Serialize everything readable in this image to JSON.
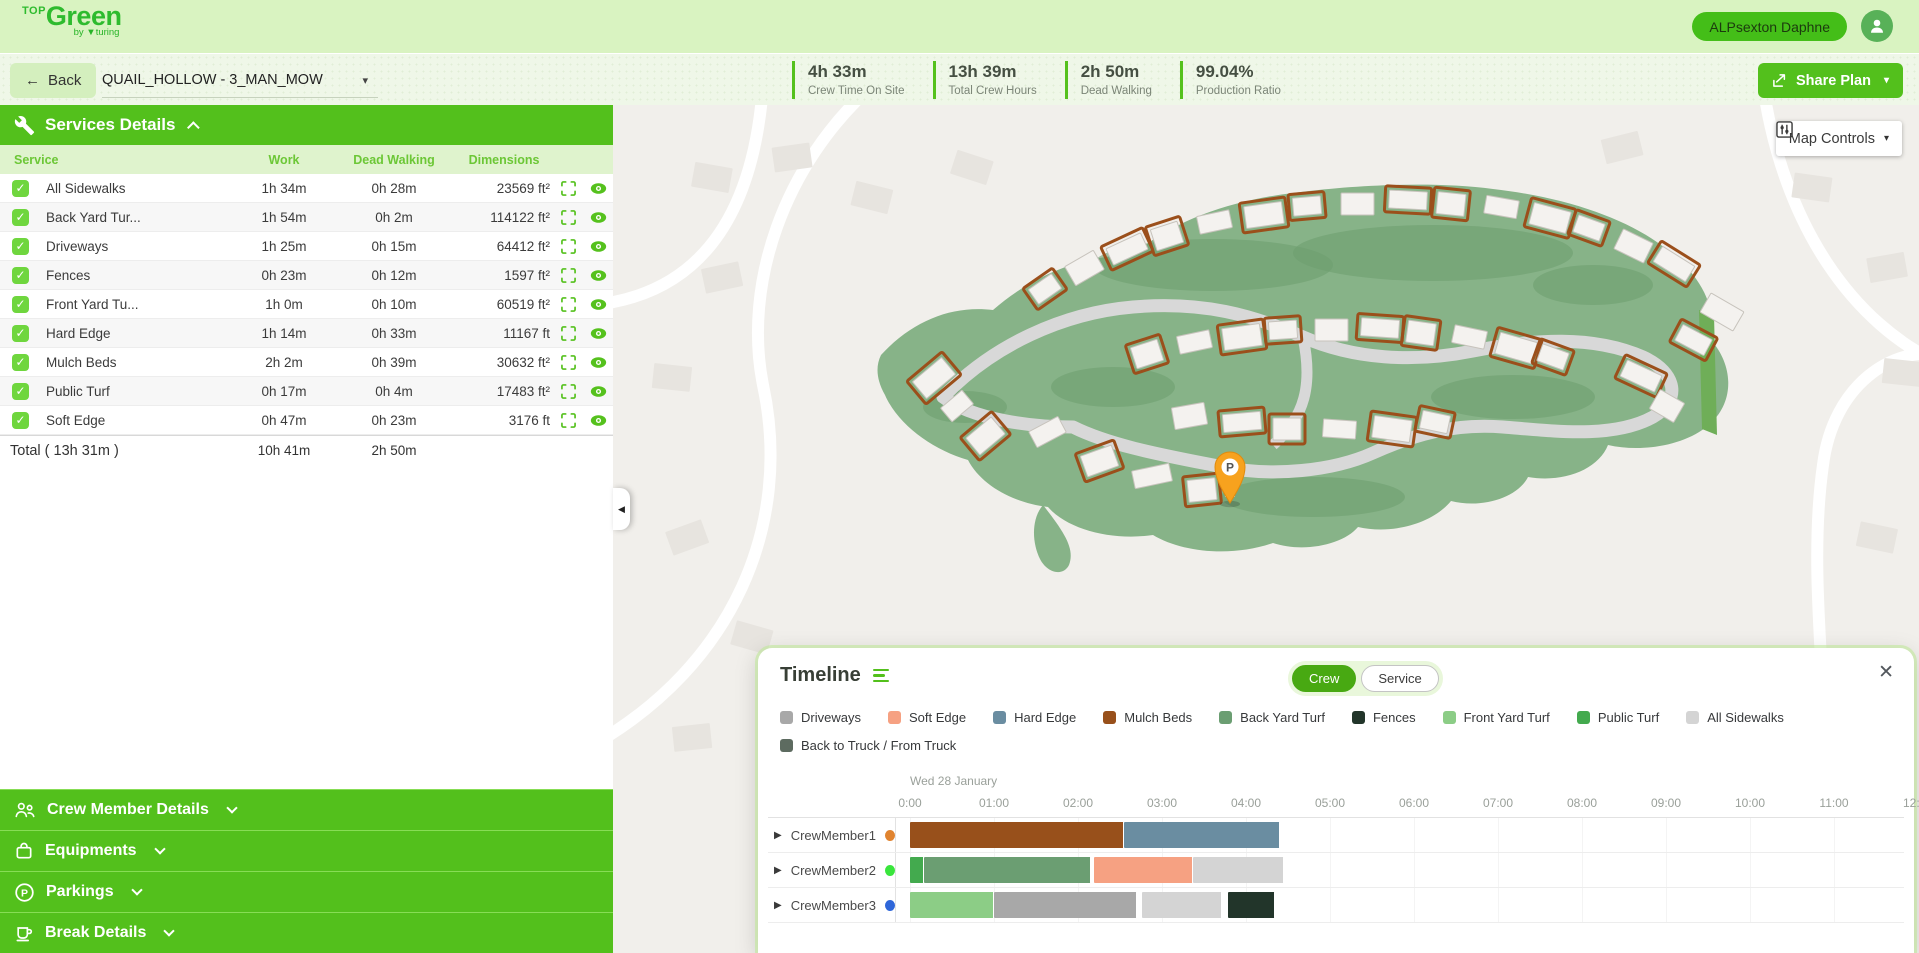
{
  "icons": {
    "caret_down": "▾",
    "back_arrow": "←",
    "row_expand": "▶",
    "panel_collapse": "◀",
    "close": "✕",
    "check": "✓"
  },
  "header": {
    "logo": {
      "top": "TOP",
      "main": "Green",
      "by": "by",
      "turing": "▼turing"
    },
    "user_name": "ALPsexton Daphne"
  },
  "toolbar": {
    "back_label": "Back",
    "plan_selector": "QUAIL_HOLLOW - 3_MAN_MOW",
    "stats": [
      {
        "value": "4h 33m",
        "label": "Crew Time On Site"
      },
      {
        "value": "13h 39m",
        "label": "Total Crew Hours"
      },
      {
        "value": "2h 50m",
        "label": "Dead Walking"
      },
      {
        "value": "99.04%",
        "label": "Production Ratio"
      }
    ],
    "share_label": "Share Plan"
  },
  "sidebar": {
    "services": {
      "title": "Services Details",
      "columns": [
        "Service",
        "Work",
        "Dead Walking",
        "Dimensions"
      ],
      "rows": [
        {
          "name": "All Sidewalks",
          "color": "#d6d6d6",
          "work": "1h 34m",
          "dead_walking": "0h 28m",
          "dimensions": "23569 ft²"
        },
        {
          "name": "Back Yard Tur...",
          "color": "#6b9e72",
          "work": "1h 54m",
          "dead_walking": "0h 2m",
          "dimensions": "114122 ft²"
        },
        {
          "name": "Driveways",
          "color": "#a8a8a8",
          "work": "1h 25m",
          "dead_walking": "0h 15m",
          "dimensions": "64412 ft²"
        },
        {
          "name": "Fences",
          "color": "#22352a",
          "work": "0h 23m",
          "dead_walking": "0h 12m",
          "dimensions": "1597 ft²"
        },
        {
          "name": "Front Yard Tu...",
          "color": "#8ccd86",
          "work": "1h 0m",
          "dead_walking": "0h 10m",
          "dimensions": "60519 ft²"
        },
        {
          "name": "Hard Edge",
          "color": "#6a8da1",
          "work": "1h 14m",
          "dead_walking": "0h 33m",
          "dimensions": "11167 ft"
        },
        {
          "name": "Mulch Beds",
          "color": "#98501b",
          "work": "2h 2m",
          "dead_walking": "0h 39m",
          "dimensions": "30632 ft²"
        },
        {
          "name": "Public Turf",
          "color": "#43aa4e",
          "work": "0h 17m",
          "dead_walking": "0h 4m",
          "dimensions": "17483 ft²"
        },
        {
          "name": "Soft Edge",
          "color": "#f6a182",
          "work": "0h 47m",
          "dead_walking": "0h 23m",
          "dimensions": "3176 ft"
        }
      ],
      "total": {
        "label": "Total ( 13h 31m )",
        "work": "10h 41m",
        "dead_walking": "2h 50m"
      }
    },
    "sections": [
      {
        "label": "Crew Member Details"
      },
      {
        "label": "Equipments"
      },
      {
        "label": "Parkings"
      },
      {
        "label": "Break Details"
      }
    ]
  },
  "map": {
    "controls_label": "Map Controls",
    "parking_label": "P",
    "attribution": [
      "Keyboard shortcuts",
      "Map data ©2026 Google",
      "Terms",
      "Report a map error"
    ]
  },
  "timeline": {
    "title": "Timeline",
    "toggle": {
      "crew": "Crew",
      "service": "Service",
      "active": "Crew"
    },
    "legend": [
      {
        "label": "Driveways",
        "color": "#a8a8a8"
      },
      {
        "label": "Soft Edge",
        "color": "#f6a182"
      },
      {
        "label": "Hard Edge",
        "color": "#6a8da1"
      },
      {
        "label": "Mulch Beds",
        "color": "#98501b"
      },
      {
        "label": "Back Yard Turf",
        "color": "#6b9e72"
      },
      {
        "label": "Fences",
        "color": "#22352a"
      },
      {
        "label": "Front Yard Turf",
        "color": "#8ccd86"
      },
      {
        "label": "Public Turf",
        "color": "#43aa4e"
      },
      {
        "label": "All Sidewalks",
        "color": "#d4d4d4"
      },
      {
        "label": "Back to Truck / From Truck",
        "color": "#5d6b60"
      }
    ],
    "axis": {
      "date": "Wed 28 January",
      "ticks": [
        "0:00",
        "01:00",
        "02:00",
        "03:00",
        "04:00",
        "05:00",
        "06:00",
        "07:00",
        "08:00",
        "09:00",
        "10:00",
        "11:00",
        "12:00"
      ]
    },
    "rows": [
      {
        "name": "CrewMember1",
        "dot_color": "#e0832f",
        "segments": [
          {
            "service": "Mulch Beds",
            "start": 0,
            "end": 2.55
          },
          {
            "service": "Hard Edge",
            "start": 2.55,
            "end": 4.4
          }
        ]
      },
      {
        "name": "CrewMember2",
        "dot_color": "#39e53c",
        "segments": [
          {
            "service": "Public Turf",
            "start": 0,
            "end": 0.17
          },
          {
            "service": "Back Yard Turf",
            "start": 0.17,
            "end": 2.16
          },
          {
            "service": "Soft Edge",
            "start": 2.19,
            "end": 3.37
          },
          {
            "service": "All Sidewalks",
            "start": 3.37,
            "end": 4.45
          }
        ]
      },
      {
        "name": "CrewMember3",
        "dot_color": "#2e66d9",
        "segments": [
          {
            "service": "Front Yard Turf",
            "start": 0,
            "end": 1.0
          },
          {
            "service": "Driveways",
            "start": 1.0,
            "end": 2.7
          },
          {
            "service": "All Sidewalks",
            "start": 2.76,
            "end": 3.72
          },
          {
            "service": "Fences",
            "start": 3.78,
            "end": 4.35
          }
        ]
      }
    ]
  }
}
